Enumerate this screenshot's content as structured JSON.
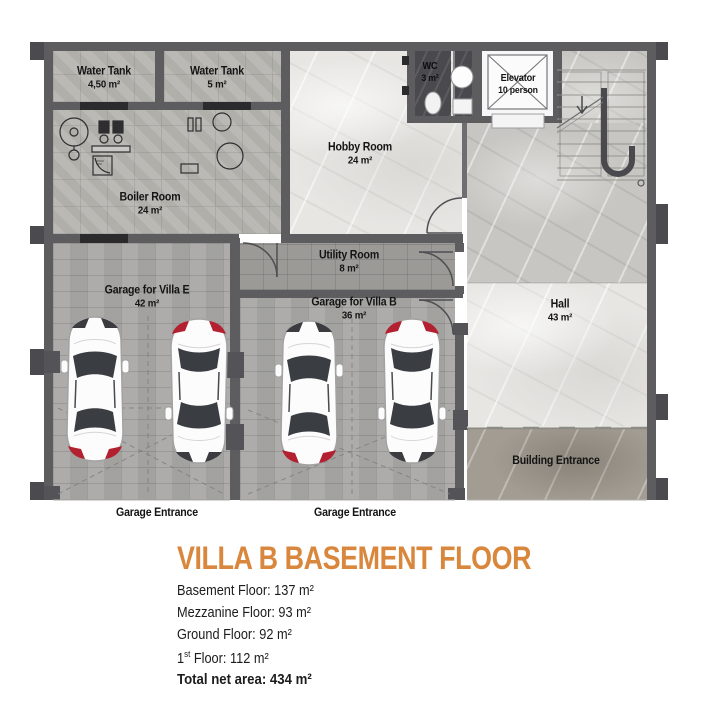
{
  "plan": {
    "rooms": {
      "water_tank_1": {
        "name": "Water Tank",
        "area": "4,50 m²"
      },
      "water_tank_2": {
        "name": "Water Tank",
        "area": "5 m²"
      },
      "wc": {
        "name": "WC",
        "area": "3 m²"
      },
      "elevator": {
        "name": "Elevator",
        "capacity": "10 person"
      },
      "hobby_room": {
        "name": "Hobby Room",
        "area": "24 m²"
      },
      "boiler_room": {
        "name": "Boiler Room",
        "area": "24 m²"
      },
      "utility_room": {
        "name": "Utility Room",
        "area": "8 m²"
      },
      "garage_villa_e": {
        "name": "Garage for Villa E",
        "area": "42 m²"
      },
      "garage_villa_b": {
        "name": "Garage for Villa B",
        "area": "36 m²"
      },
      "hall": {
        "name": "Hall",
        "area": "43 m²"
      },
      "building_entrance": {
        "name": "Building Entrance"
      },
      "garage_entrance_left": {
        "name": "Garage Entrance"
      },
      "garage_entrance_right": {
        "name": "Garage Entrance"
      }
    }
  },
  "legend": {
    "title": "VILLA B BASEMENT FLOOR",
    "lines": [
      {
        "text": "Basement Floor: 137 m²"
      },
      {
        "text": "Mezzanine Floor: 93 m²"
      },
      {
        "text": "Ground Floor: 92 m²"
      },
      {
        "prefix": "1",
        "sup": "st",
        "rest": " Floor: 112 m²"
      },
      {
        "text": "Total net area: 434 m²",
        "emphasis": true
      }
    ]
  },
  "colors": {
    "accent_orange": "#d9873c",
    "wall_grey": "#5d5d60",
    "car_accent_red": "#b3202f"
  }
}
